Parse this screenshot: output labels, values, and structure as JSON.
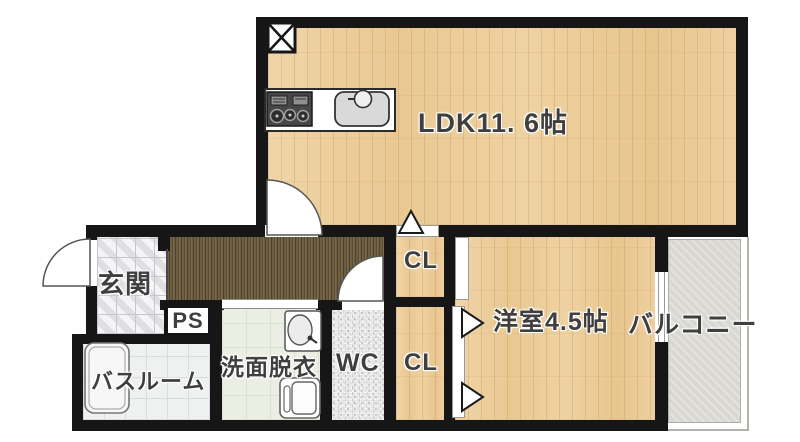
{
  "rooms": {
    "ldk": {
      "label": "LDK11. 6帖"
    },
    "entrance": {
      "label": "玄関"
    },
    "pipe_space": {
      "label": "PS"
    },
    "bathroom": {
      "label": "バスルーム"
    },
    "washroom": {
      "label": "洗面脱衣"
    },
    "toilet": {
      "label": "WC"
    },
    "closet_upper": {
      "label": "CL"
    },
    "closet_lower": {
      "label": "CL"
    },
    "western_room": {
      "label": "洋室4.5帖"
    },
    "balcony": {
      "label": "バルコニー"
    }
  },
  "colors": {
    "wall": "#161616",
    "wood": "#edcf9f",
    "corridor": "#6f5f40",
    "tile": "#e8e8eb",
    "bath": "#eef1f0",
    "washroom": "#ebefe3",
    "wc": "#e3e3e3",
    "balcony": "#d8d7d2",
    "text": "#3f3f3f"
  }
}
